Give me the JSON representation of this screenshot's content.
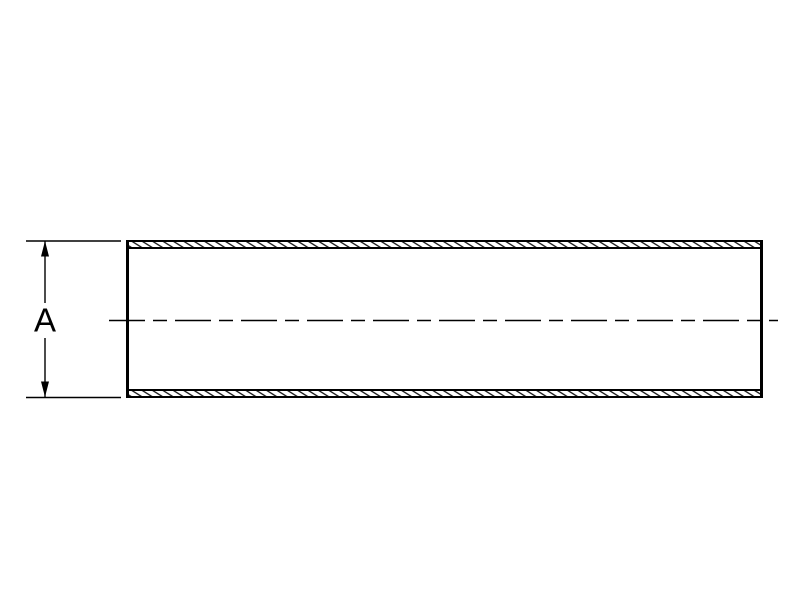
{
  "drawing": {
    "dimension_label": "A",
    "colors": {
      "ink": "#000000",
      "background": "#ffffff"
    }
  }
}
